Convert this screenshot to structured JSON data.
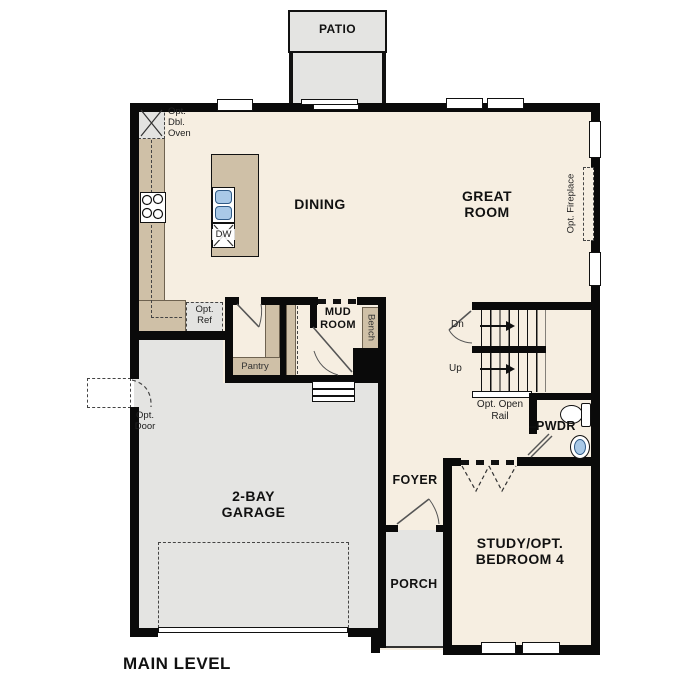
{
  "plan_title": "MAIN LEVEL",
  "rooms": {
    "patio": "PATIO",
    "dining": "DINING",
    "great_room": "GREAT\nROOM",
    "mud_room": "MUD\nROOM",
    "garage": "2-BAY\nGARAGE",
    "foyer": "FOYER",
    "porch": "PORCH",
    "study": "STUDY/OPT.\nBEDROOM 4",
    "powder": "PWDR"
  },
  "annotations": {
    "opt_dbl_oven": "Opt.\nDbl.\nOven",
    "opt_ref": "Opt.\nRef",
    "dishwasher": "DW",
    "pantry": "Pantry",
    "bench": "Bench",
    "stairs_down": "Dn",
    "stairs_up": "Up",
    "opt_open_rail": "Opt. Open\nRail",
    "opt_door": "Opt.\nDoor",
    "opt_fireplace": "Opt. Fireplace"
  },
  "colors": {
    "floor": "#f6eee1",
    "outdoor": "#e4e4e2",
    "cabinet": "#cfc0a7",
    "wall": "#0a0a0a",
    "sink_blue": "#a9c9e7"
  }
}
